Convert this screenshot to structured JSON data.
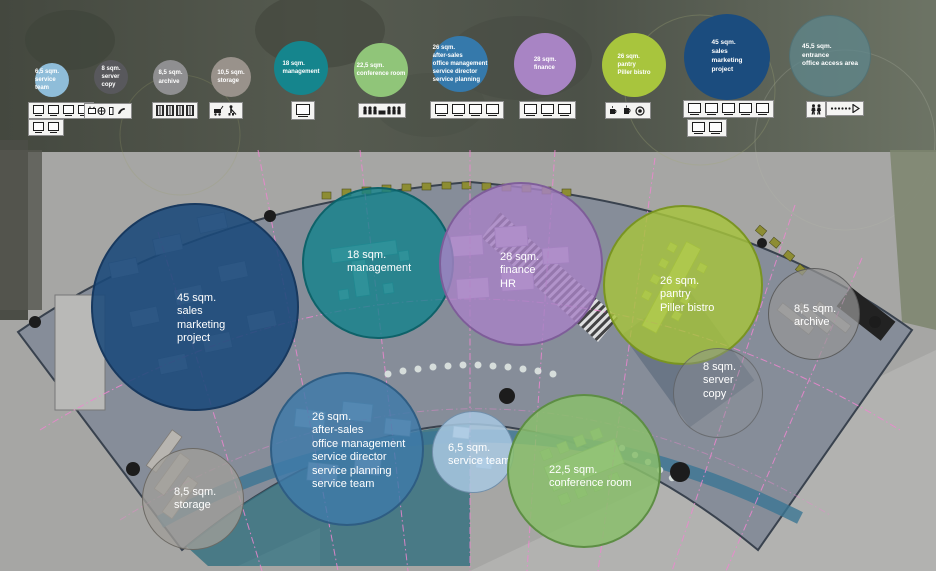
{
  "legend": {
    "items": [
      {
        "id": "service-team",
        "label": "6,5 sqm.\nservice team",
        "color": "#8fbdd9",
        "icons": [
          "monitor",
          "monitor",
          "monitor",
          "monitor",
          "monitor",
          "monitor"
        ]
      },
      {
        "id": "server-copy",
        "label": "8 sqm.\nserver\ncopy",
        "color": "#58585c",
        "icons": [
          "printer",
          "copier",
          "mobile-phone",
          "phone"
        ]
      },
      {
        "id": "archive",
        "label": "8,5 sqm.\narchive",
        "color": "#8f8f91",
        "icons": [
          "shelf",
          "shelf",
          "shelf",
          "shelf"
        ]
      },
      {
        "id": "storage",
        "label": "10,5 sqm.\nstorage",
        "color": "#99928b",
        "icons": [
          "cleaning-cart",
          "cleaner"
        ]
      },
      {
        "id": "management",
        "label": "18 sqm.\nmanagement",
        "color": "#15858d",
        "icons": [
          "monitor"
        ]
      },
      {
        "id": "conference-room",
        "label": "22,5 sqm.\nconference room",
        "color": "#90c579",
        "icons": [
          "meeting-silhouette"
        ]
      },
      {
        "id": "after-sales",
        "label": "26 sqm.\nafter-sales\noffice management\nservice director\nservice planning",
        "color": "#3579ab",
        "icons": [
          "monitor",
          "monitor",
          "monitor",
          "monitor"
        ]
      },
      {
        "id": "finance",
        "label": "28 sqm.\nfinance",
        "color": "#a884c4",
        "icons": [
          "monitor",
          "monitor",
          "monitor"
        ]
      },
      {
        "id": "pantry",
        "label": "26 sqm.\npantry\nPiller bistro",
        "color": "#a8c53d",
        "icons": [
          "coffee-cup",
          "coffee-mug",
          "plate"
        ]
      },
      {
        "id": "sales",
        "label": "45 sqm.\nsales\nmarketing\nproject",
        "color": "#1b4c7e",
        "icons": [
          "monitor",
          "monitor",
          "monitor",
          "monitor",
          "monitor",
          "monitor",
          "monitor"
        ]
      },
      {
        "id": "entrance",
        "label": "45,5 sqm.\nentrance\noffice access area",
        "color": "#5f878c",
        "icons": [
          "people",
          "walk-arrow"
        ]
      }
    ]
  },
  "plan": {
    "bubbles": [
      {
        "id": "sales",
        "label": "45 sqm.\nsales\nmarketing\nproject",
        "color": "#1a497a"
      },
      {
        "id": "management",
        "label": "18 sqm.\nmanagement",
        "color": "#10828a"
      },
      {
        "id": "finance",
        "label": "28 sqm.\nfinance\nHR",
        "color": "#a782c5"
      },
      {
        "id": "pantry",
        "label": "26 sqm.\npantry\nPiller bistro",
        "color": "#a7c53c"
      },
      {
        "id": "archive",
        "label": "8,5 sqm.\narchive",
        "color": "#969696"
      },
      {
        "id": "server-copy",
        "label": "8 sqm.\nserver\ncopy",
        "color": "#8c9196"
      },
      {
        "id": "after-sales",
        "label": "26 sqm.\nafter-sales\noffice management\nservice director\nservice planning\nservice team",
        "color": "#3e7aa8"
      },
      {
        "id": "service-team",
        "label": "6,5 sqm.\nservice team",
        "color": "#a8c8e2"
      },
      {
        "id": "conference-room",
        "label": "22,5 sqm.\nconference room",
        "color": "#8abe6c"
      },
      {
        "id": "storage",
        "label": "8,5 sqm.\nstorage",
        "color": "#a09d98"
      }
    ]
  },
  "colors": {
    "grid_pink": "#ee86d0",
    "corridor_blue": "#3b7693",
    "floor_teal": "#35707f",
    "column_black": "#1c1c1c"
  }
}
